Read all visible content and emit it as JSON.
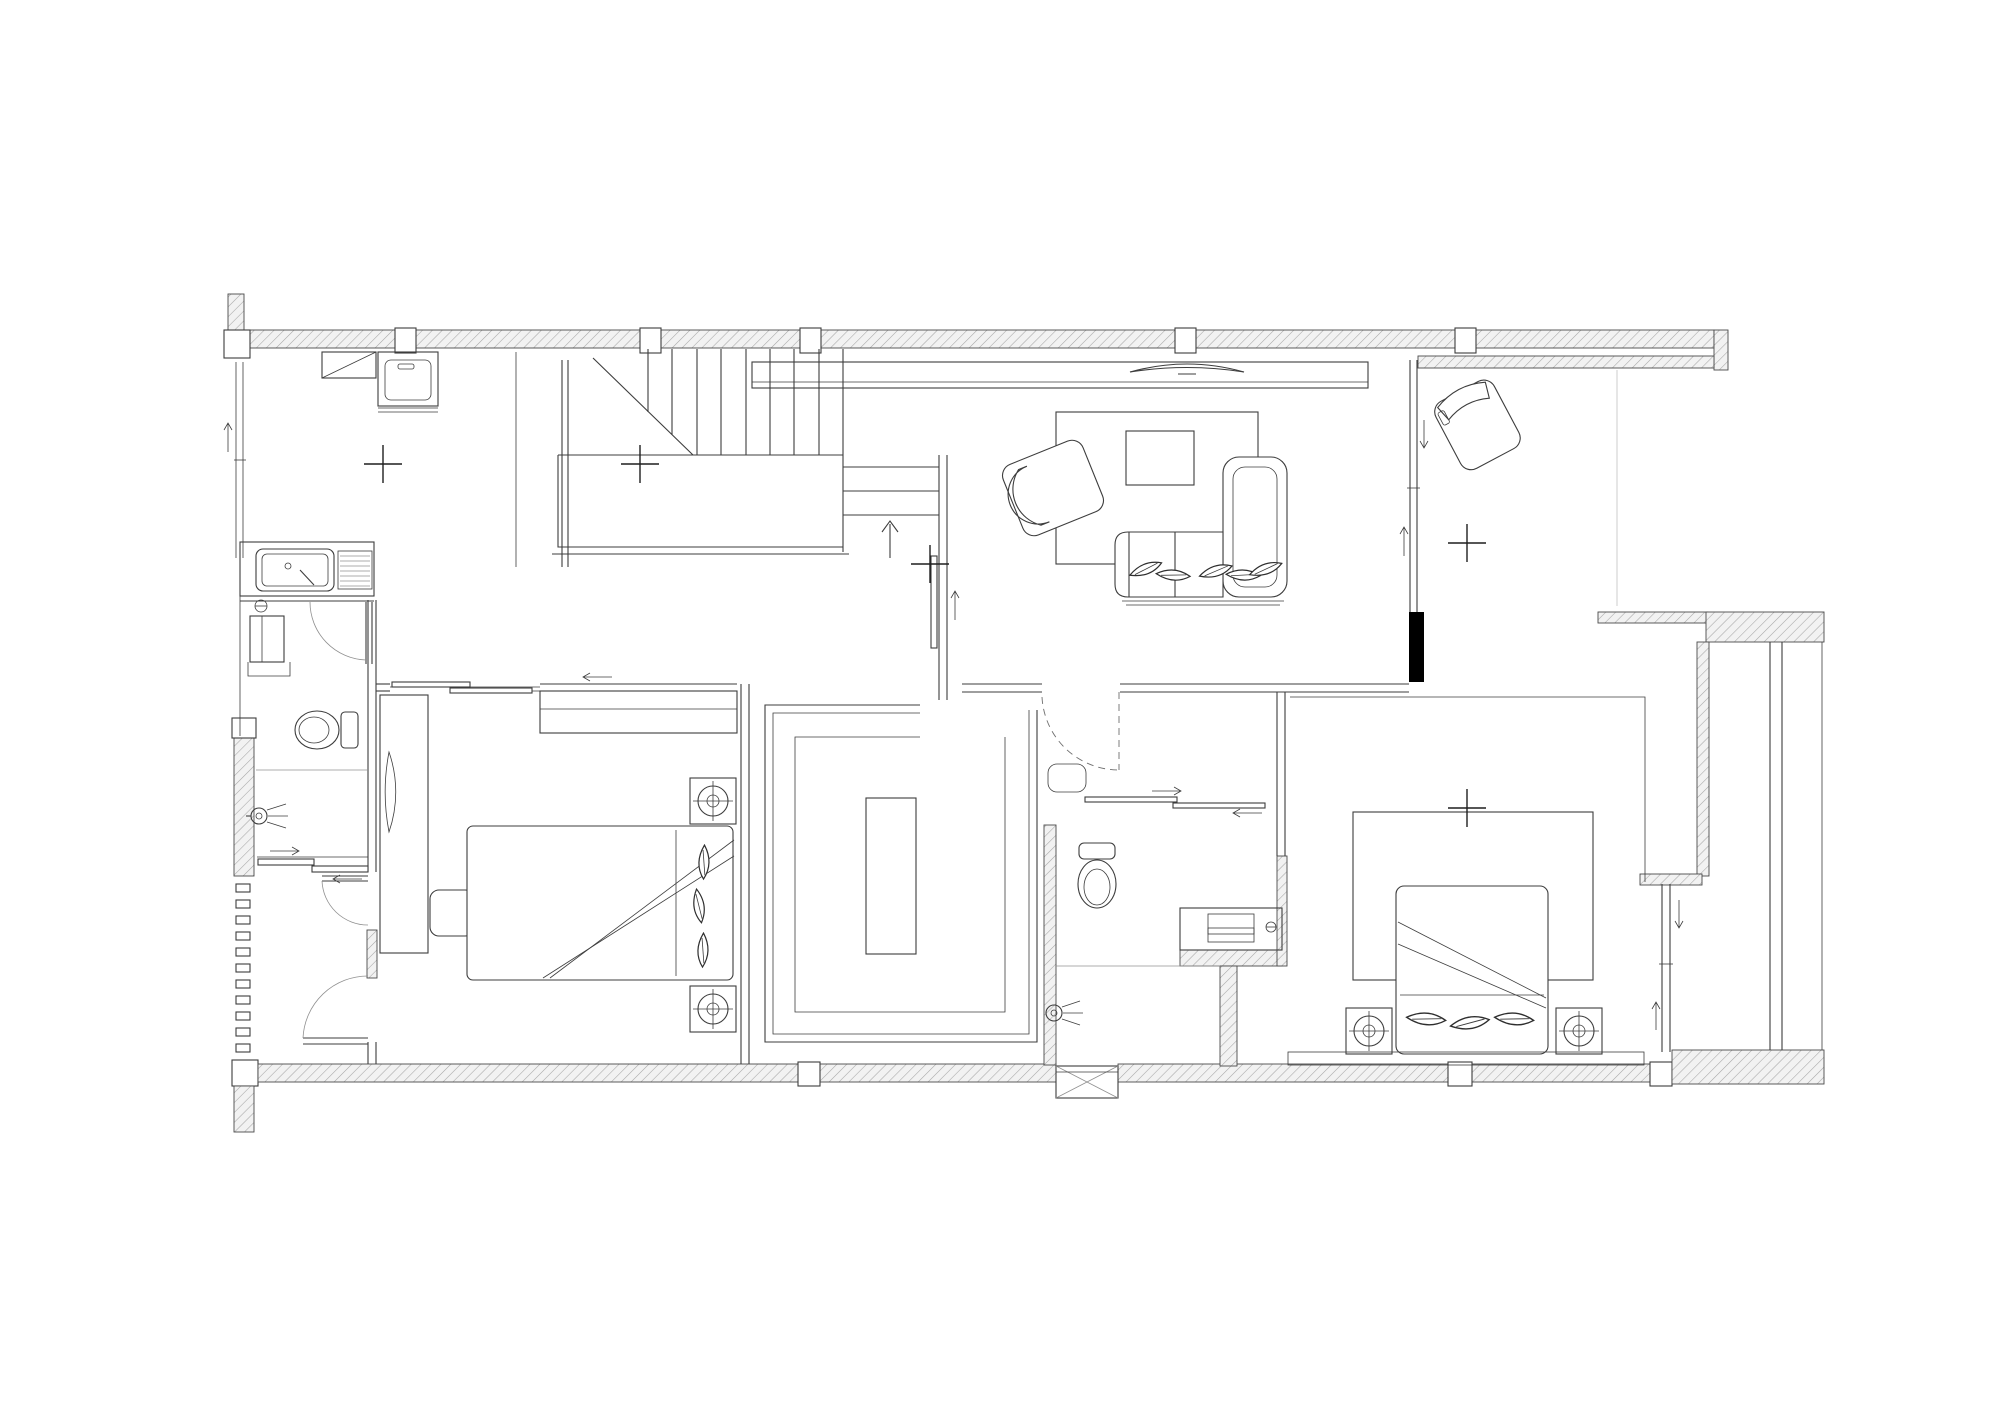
{
  "meta": {
    "title": "Residential floor plan - line drawing (no text labels visible)",
    "canvas": {
      "width": 2000,
      "height": 1413
    },
    "drawing_style": "black-and-white CAD plan with cross-hatched walls"
  },
  "colors": {
    "background": "#ffffff",
    "line": "#3d3d3d",
    "light_line": "#909090",
    "hatch_line": "#a6a6a6",
    "hatch_fill": "#f2f2f2",
    "poche_black": "#000000"
  },
  "symbols": {
    "center_marks": [
      {
        "x": 383,
        "y": 464
      },
      {
        "x": 640,
        "y": 464
      },
      {
        "x": 930,
        "y": 564
      },
      {
        "x": 1467,
        "y": 543
      },
      {
        "x": 1467,
        "y": 808
      }
    ],
    "stair_up_arrow": {
      "x": 890,
      "y": 540,
      "direction": "up"
    },
    "window_arrow_count": 6,
    "sliding_door_arrow_count": 5
  },
  "stair": {
    "visible_risers": 9,
    "lower_flight_treads": 3,
    "has_landing": true,
    "has_break_line": true
  },
  "rooms": [
    {
      "id": "laundry",
      "label": "utility-area",
      "items": [
        "counter-with-diagonal",
        "washing-machine"
      ]
    },
    {
      "id": "kitchenette",
      "label": "kitchenette",
      "items": [
        "sink-counter",
        "drainboard",
        "faucet"
      ]
    },
    {
      "id": "bathroom1",
      "label": "bathroom-west",
      "items": [
        "swing-door",
        "tall-cabinet",
        "toilet",
        "shower-head",
        "sliding-door-2-panel"
      ]
    },
    {
      "id": "stairhall",
      "label": "stair-hall",
      "items": [
        "staircase",
        "landing",
        "up-arrow"
      ]
    },
    {
      "id": "living",
      "label": "living-room",
      "items": [
        "media-console",
        "curved-tv",
        "rug",
        "coffee-table",
        "armchair-rotated",
        "sectional-sofa-with-chaise",
        "sofa-pillows-x5"
      ]
    },
    {
      "id": "terrace",
      "label": "terrace-north-east",
      "items": [
        "lounge-chair-rotated",
        "glazed-partition"
      ]
    },
    {
      "id": "bedroom1",
      "label": "bedroom-west",
      "items": [
        "sliding-entry-door",
        "wardrobe-band",
        "desk",
        "monitor",
        "task-chair",
        "double-bed",
        "bed-pillows-x3",
        "nightstand-with-lamp-x2",
        "swing-door-x2"
      ]
    },
    {
      "id": "closet",
      "label": "walk-in-closet",
      "items": [
        "u-shaped-wardrobe",
        "island-unit"
      ]
    },
    {
      "id": "bathroom2",
      "label": "bathroom-ensuite",
      "items": [
        "dashed-swing-door",
        "wall-shelf",
        "sliding-partition-2-panel",
        "toilet",
        "vanity-with-sink",
        "shower-head"
      ]
    },
    {
      "id": "bedroom2",
      "label": "bedroom-east",
      "items": [
        "rug",
        "double-bed",
        "bed-pillows-x3",
        "nightstand-with-lamp-x2",
        "platform-strip",
        "window-wall"
      ]
    },
    {
      "id": "balcony",
      "label": "balcony-east-strip",
      "items": [
        "double-wall-line"
      ]
    }
  ],
  "wall_features": {
    "top_wall_columns": 5,
    "bottom_wall_columns": 3,
    "black_poche_column": {
      "x": 1409,
      "y": 612
    },
    "ac_shaft_box_with_x": {
      "x": 1056,
      "y": 1066
    },
    "ladder_pattern_wall_ticks": 11
  }
}
